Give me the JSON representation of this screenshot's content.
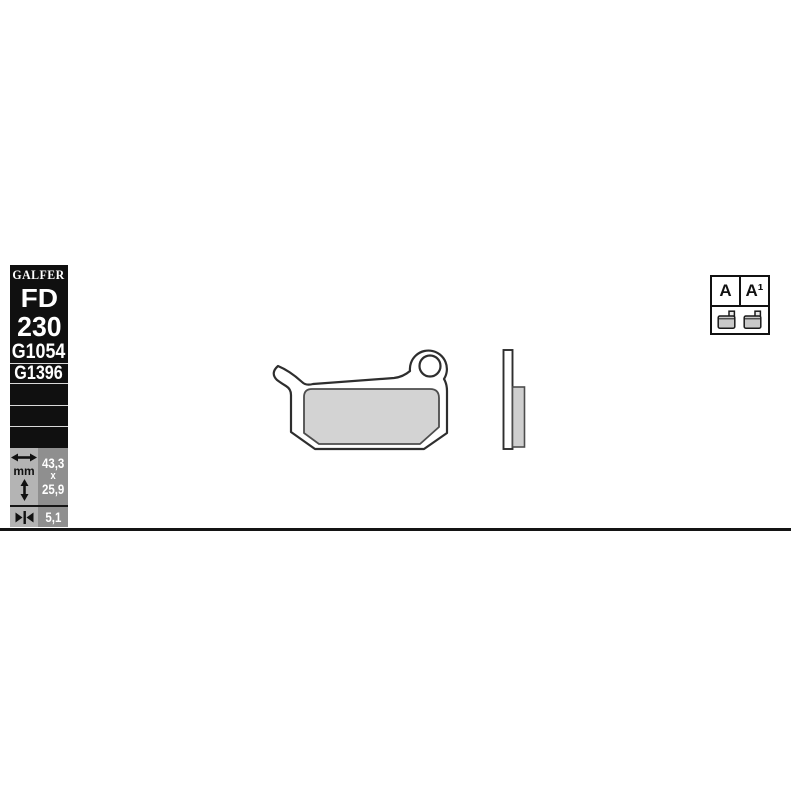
{
  "spec_panel": {
    "brand": "GALFER",
    "model_prefix": "FD",
    "model_number": "230",
    "reference_1": "G1054",
    "reference_2": "G1396",
    "panel_bg": "#101010",
    "text_color": "#ffffff"
  },
  "dimensions": {
    "unit_label": "mm",
    "width_value": "43,3",
    "separator": "x",
    "height_value": "25,9",
    "thickness_value": "5,1",
    "icon_cell_bg": "#b4b4b4",
    "value_cell_bg": "#8f8f8f",
    "icons": {
      "width": "horizontal-double-arrow-icon",
      "height": "vertical-double-arrow-icon",
      "thickness": "pinch-arrows-icon"
    }
  },
  "legend": {
    "variant_a_label": "A",
    "variant_a1_label": "A¹",
    "pad_icons": "brake-pad-icon x2"
  },
  "drawing": {
    "subject": "brake pad front view with mounting hole lug and side view",
    "pad_material_fill": "#d3d3d3",
    "outline_color": "#2e2e2e",
    "backing_fill": "#ffffff"
  }
}
